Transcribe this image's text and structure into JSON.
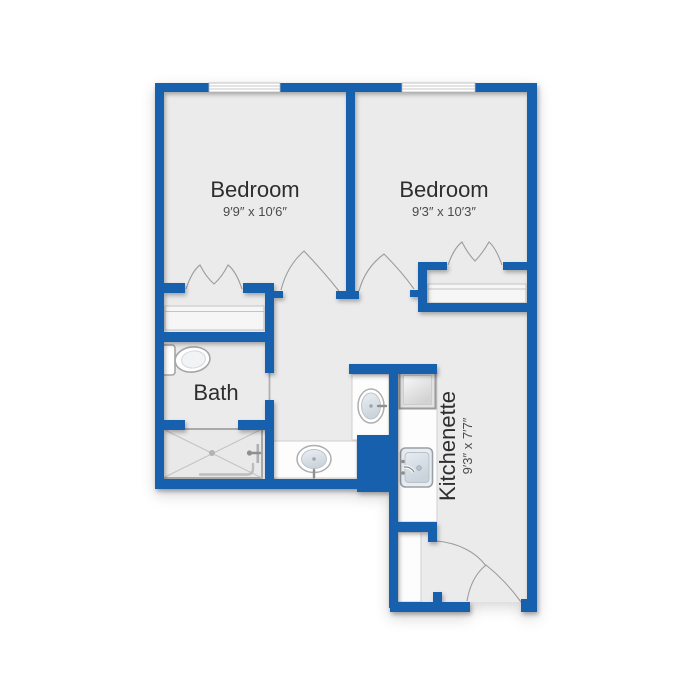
{
  "floorplan": {
    "rooms": {
      "bedroom1": {
        "label": "Bedroom",
        "dimensions": "9′9″ x 10′6″"
      },
      "bedroom2": {
        "label": "Bedroom",
        "dimensions": "9′3″ x 10′3″"
      },
      "bath": {
        "label": "Bath"
      },
      "kitchenette": {
        "label": "Kitchenette",
        "dimensions": "9′3″ x 7′7″"
      }
    },
    "colors": {
      "wall": "#1560ad",
      "floor": "#ebebeb",
      "fixture_stroke": "#a6a6a6",
      "counter_fill": "#fdfdfd",
      "label_text": "#2d2d2d",
      "dim_text": "#4b4b4b"
    },
    "icons": {
      "window-icon": "double-line band in wall",
      "bifold-door-icon": "zigzag arcs",
      "door-swing-icon": "peaked arc pair",
      "toilet-icon": "tank + oval bowl",
      "shower-icon": "crossed rectangle with drain",
      "vanity-sink-icon": "oval basin",
      "kitchen-sink-icon": "rounded basin with faucet",
      "refrigerator-icon": "framed square"
    }
  }
}
